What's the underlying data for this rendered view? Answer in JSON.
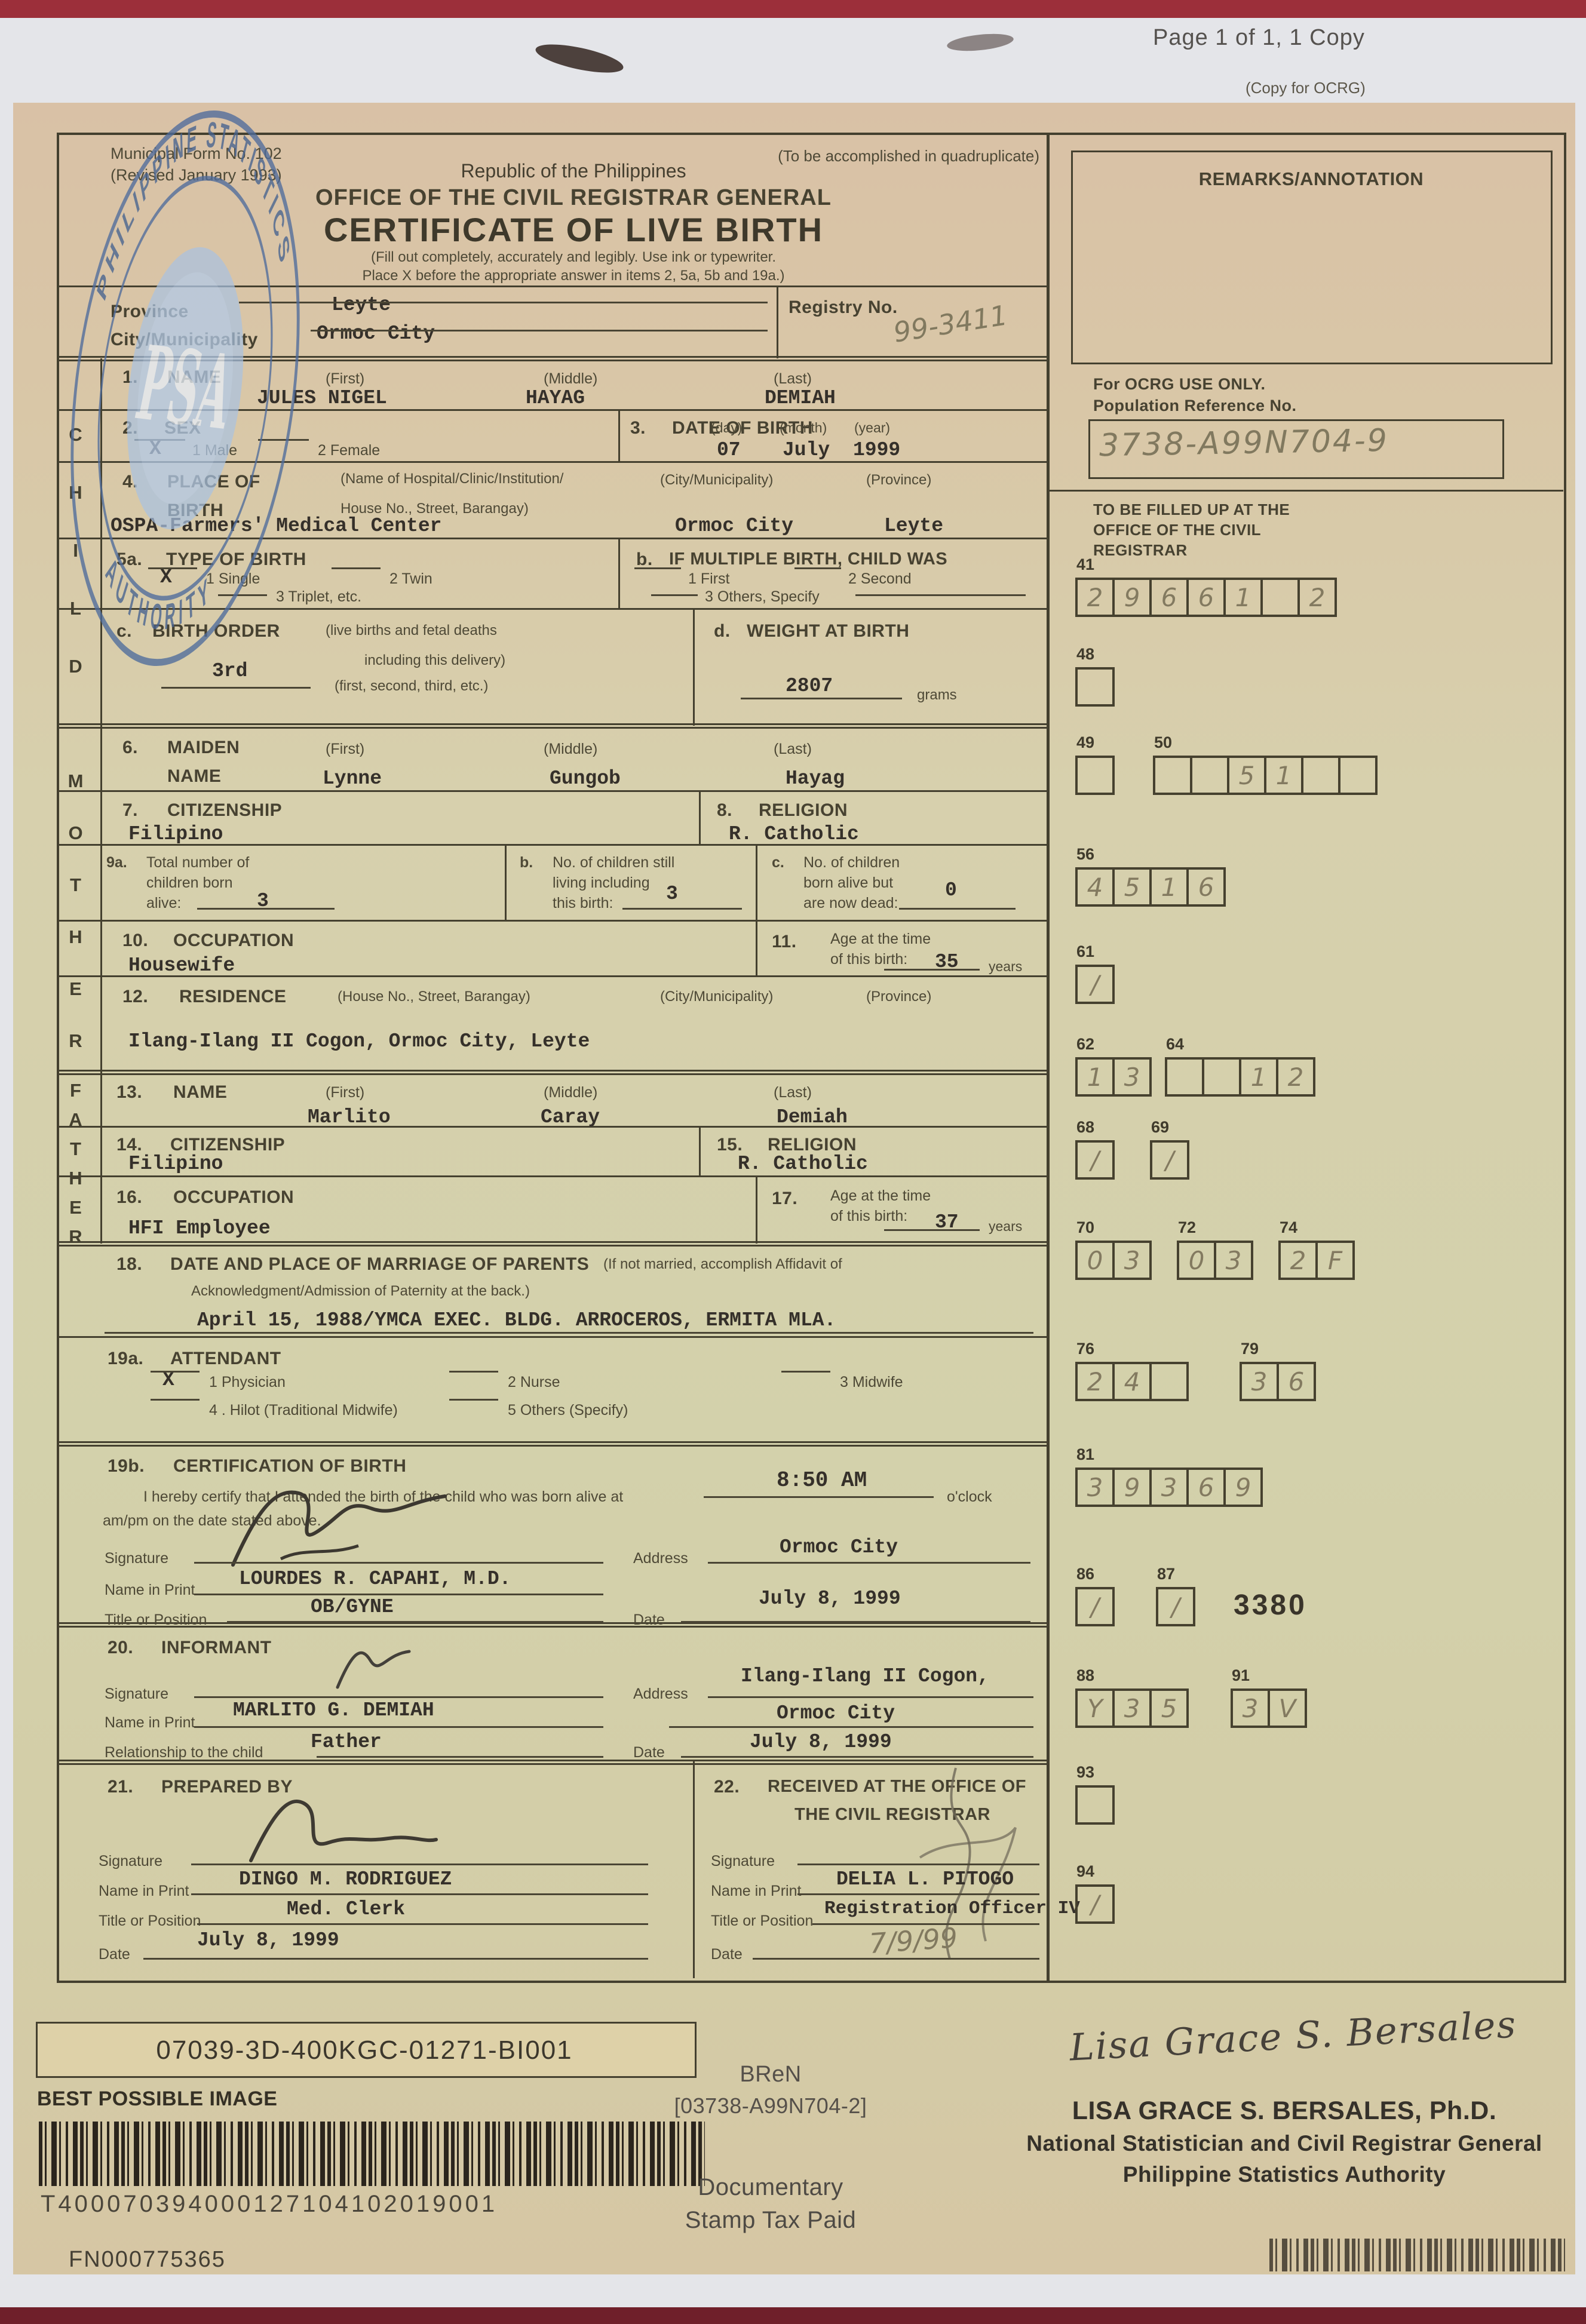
{
  "page": {
    "header": "Page 1 of 1, 1 Copy",
    "copy_label": "(Copy for OCRG)"
  },
  "form_header": {
    "form_no": "Municipal Form No. 102",
    "revised": "(Revised January 1993)",
    "quadruplicate": "(To be accomplished in quadruplicate)",
    "republic": "Republic of the Philippines",
    "office": "OFFICE OF THE CIVIL REGISTRAR GENERAL",
    "title": "CERTIFICATE OF LIVE BIRTH",
    "instructions_1": "(Fill out completely, accurately and legibly. Use ink or typewriter.",
    "instructions_2": "Place X before the appropriate answer in items 2, 5a, 5b and 19a.)"
  },
  "registry_block": {
    "province_label": "Province",
    "province_value": "Leyte",
    "city_label": "City/Municipality",
    "city_value": "Ormoc City",
    "registry_label": "Registry No.",
    "registry_value": "99-3411"
  },
  "sections": {
    "child": "CHILD",
    "mother": "MOTHER",
    "father": "FATHER"
  },
  "child": {
    "name": {
      "num": "1.",
      "label": "NAME",
      "first_label": "(First)",
      "middle_label": "(Middle)",
      "last_label": "(Last)",
      "first": "JULES NIGEL",
      "middle": "HAYAG",
      "last": "DEMIAH"
    },
    "sex": {
      "num": "2.",
      "label": "SEX",
      "mark": "X",
      "opt1": "1  Male",
      "opt2": "2  Female"
    },
    "dob": {
      "num": "3.",
      "label": "DATE OF BIRTH",
      "day_label": "(day)",
      "month_label": "(month)",
      "year_label": "(year)",
      "day": "07",
      "month": "July",
      "year": "1999"
    },
    "place": {
      "num": "4.",
      "label1": "PLACE OF",
      "label2": "BIRTH",
      "hosp_label1": "(Name of Hospital/Clinic/Institution/",
      "hosp_label2": "House No., Street, Barangay)",
      "city_label": "(City/Municipality)",
      "prov_label": "(Province)",
      "hospital": "OSPA-Farmers' Medical Center",
      "city": "Ormoc City",
      "province": "Leyte"
    },
    "type": {
      "num": "5a.",
      "label": "TYPE OF BIRTH",
      "mark": "X",
      "opt1": "1  Single",
      "opt2": "2  Twin",
      "opt3": "3  Triplet, etc.",
      "b_num": "b.",
      "b_label": "IF MULTIPLE BIRTH, CHILD WAS",
      "b_opt1": "1  First",
      "b_opt2": "2  Second",
      "b_opt3": "3  Others, Specify"
    },
    "order": {
      "num": "c.",
      "label": "BIRTH ORDER",
      "note1": "(live births and fetal deaths",
      "note2": "including this delivery)",
      "note3": "(first, second, third, etc.)",
      "value": "3rd"
    },
    "weight": {
      "num": "d.",
      "label": "WEIGHT AT BIRTH",
      "value": "2807",
      "unit": "grams"
    }
  },
  "mother": {
    "maiden": {
      "num": "6.",
      "label1": "MAIDEN",
      "label2": "NAME",
      "first_label": "(First)",
      "middle_label": "(Middle)",
      "last_label": "(Last)",
      "first": "Lynne",
      "middle": "Gungob",
      "last": "Hayag"
    },
    "citizenship": {
      "num": "7.",
      "label": "CITIZENSHIP",
      "value": "Filipino"
    },
    "religion": {
      "num": "8.",
      "label": "RELIGION",
      "value": "R. Catholic"
    },
    "children": {
      "a_num": "9a.",
      "a_label1": "Total number of",
      "a_label2": "children born",
      "a_label3": "alive:",
      "a_value": "3",
      "b_num": "b.",
      "b_label1": "No. of children still",
      "b_label2": "living including",
      "b_label3": "this birth:",
      "b_value": "3",
      "c_num": "c.",
      "c_label1": "No. of children",
      "c_label2": "born alive but",
      "c_label3": "are now dead:",
      "c_value": "0"
    },
    "occupation": {
      "num": "10.",
      "label": "OCCUPATION",
      "value": "Housewife"
    },
    "age": {
      "num": "11.",
      "label1": "Age at the time",
      "label2": "of this birth:",
      "value": "35",
      "unit": "years"
    },
    "residence": {
      "num": "12.",
      "label": "RESIDENCE",
      "sub1": "(House No., Street, Barangay)",
      "sub2": "(City/Municipality)",
      "sub3": "(Province)",
      "value": "Ilang-Ilang II Cogon, Ormoc City, Leyte"
    }
  },
  "father": {
    "name": {
      "num": "13.",
      "label": "NAME",
      "first_label": "(First)",
      "middle_label": "(Middle)",
      "last_label": "(Last)",
      "first": "Marlito",
      "middle": "Caray",
      "last": "Demiah"
    },
    "citizenship": {
      "num": "14.",
      "label": "CITIZENSHIP",
      "value": "Filipino"
    },
    "religion": {
      "num": "15.",
      "label": "RELIGION",
      "value": "R. Catholic"
    },
    "occupation": {
      "num": "16.",
      "label": "OCCUPATION",
      "value": "HFI Employee"
    },
    "age": {
      "num": "17.",
      "label1": "Age at the time",
      "label2": "of this birth:",
      "value": "37",
      "unit": "years"
    }
  },
  "marriage": {
    "num": "18.",
    "label": "DATE AND PLACE OF MARRIAGE OF PARENTS",
    "note1": "(If not married, accomplish Affidavit of",
    "note2": "Acknowledgment/Admission of Paternity at the back.)",
    "value": "April 15, 1988/YMCA EXEC. BLDG. ARROCEROS, ERMITA MLA."
  },
  "attendant": {
    "num": "19a.",
    "label": "ATTENDANT",
    "mark": "X",
    "opt1": "1  Physician",
    "opt2": "2  Nurse",
    "opt3": "3  Midwife",
    "opt4": "4 . Hilot (Traditional Midwife)",
    "opt5": "5  Others (Specify)"
  },
  "certification": {
    "num": "19b.",
    "label": "CERTIFICATION OF BIRTH",
    "text1": "I hereby certify that I attended the birth of the child who was born alive at",
    "time": "8:50 AM",
    "oclock": "o'clock",
    "text2": "am/pm on the date stated above.",
    "sig_label": "Signature",
    "name_label": "Name in Print",
    "title_label": "Title or Position",
    "addr_label": "Address",
    "date_label": "Date",
    "name": "LOURDES R. CAPAHI, M.D.",
    "title": "OB/GYNE",
    "address": "Ormoc City",
    "date": "July 8, 1999"
  },
  "informant": {
    "num": "20.",
    "label": "INFORMANT",
    "sig_label": "Signature",
    "name_label": "Name in Print",
    "rel_label": "Relationship to the child",
    "addr_label": "Address",
    "date_label": "Date",
    "name": "MARLITO G. DEMIAH",
    "relationship": "Father",
    "address1": "Ilang-Ilang II Cogon,",
    "address2": "Ormoc City",
    "date": "July 8, 1999"
  },
  "prepared": {
    "num": "21.",
    "label": "PREPARED BY",
    "sig_label": "Signature",
    "name_label": "Name in Print",
    "title_label": "Title or Position",
    "date_label": "Date",
    "name": "DINGO M. RODRIGUEZ",
    "title": "Med. Clerk",
    "date": "July 8, 1999"
  },
  "received": {
    "num": "22.",
    "label1": "RECEIVED AT THE OFFICE OF",
    "label2": "THE CIVIL REGISTRAR",
    "sig_label": "Signature",
    "name_label": "Name in Print",
    "title_label": "Title or Position",
    "date_label": "Date",
    "name": "DELIA L. PITOGO",
    "title": "Registration Officer IV",
    "date": "7/9/99"
  },
  "ocrg": {
    "remarks": "REMARKS/ANNOTATION",
    "use_only": "For OCRG USE ONLY.",
    "pop_ref": "Population Reference No.",
    "pop_ref_value": "3738-A99N704-9",
    "fill_note1": "TO BE FILLED UP AT THE",
    "fill_note2": "OFFICE OF THE CIVIL",
    "fill_note3": "REGISTRAR",
    "code": "3380",
    "fields": [
      {
        "num": "41",
        "cells": [
          "2",
          "9",
          "6",
          "6",
          "1",
          "",
          "2"
        ]
      },
      {
        "num": "48",
        "cells": [
          ""
        ]
      },
      {
        "num": "49",
        "cells": [
          ""
        ]
      },
      {
        "num": "50",
        "cells": [
          "",
          "",
          "5",
          "1",
          "",
          ""
        ]
      },
      {
        "num": "56",
        "cells": [
          "4",
          "5",
          "1",
          "6"
        ]
      },
      {
        "num": "61",
        "cells": [
          "/"
        ]
      },
      {
        "num": "62",
        "cells": [
          "1",
          "3"
        ]
      },
      {
        "num": "64",
        "cells": [
          "",
          "",
          "1",
          "2"
        ]
      },
      {
        "num": "68",
        "cells": [
          "/"
        ]
      },
      {
        "num": "69",
        "cells": [
          "/"
        ]
      },
      {
        "num": "70",
        "cells": [
          "0",
          "3"
        ]
      },
      {
        "num": "72",
        "cells": [
          "0",
          "3"
        ]
      },
      {
        "num": "74",
        "cells": [
          "2",
          "F"
        ]
      },
      {
        "num": "76",
        "cells": [
          "2",
          "4",
          ""
        ]
      },
      {
        "num": "79",
        "cells": [
          "3",
          "6"
        ]
      },
      {
        "num": "81",
        "cells": [
          "3",
          "9",
          "3",
          "6",
          "9"
        ]
      },
      {
        "num": "86",
        "cells": [
          "/"
        ]
      },
      {
        "num": "87",
        "cells": [
          "/"
        ]
      },
      {
        "num": "88",
        "cells": [
          "Y",
          "3",
          "5"
        ]
      },
      {
        "num": "91",
        "cells": [
          "3",
          "V"
        ]
      },
      {
        "num": "93",
        "cells": [
          ""
        ]
      },
      {
        "num": "94",
        "cells": [
          "/"
        ]
      }
    ]
  },
  "stamp": {
    "ring_top": "PHILIPPINE STATISTICS",
    "ring_bottom": "AUTHORITY",
    "center": "PSA"
  },
  "footer": {
    "image_code": "07039-3D-400KGC-01271-BI001",
    "best_possible": "BEST POSSIBLE IMAGE",
    "barcode_number": "T400070394000127104102019001",
    "fn_number": "FN000775365",
    "bren_label": "BReN",
    "bren_number": "[03738-A99N704-2]",
    "dst1": "Documentary",
    "dst2": "Stamp Tax Paid",
    "signature_script": "Lisa Grace S. Bersales",
    "signer_name": "LISA GRACE S. BERSALES, Ph.D.",
    "signer_title1": "National Statistician and Civil Registrar General",
    "signer_title2": "Philippine Statistics Authority"
  }
}
